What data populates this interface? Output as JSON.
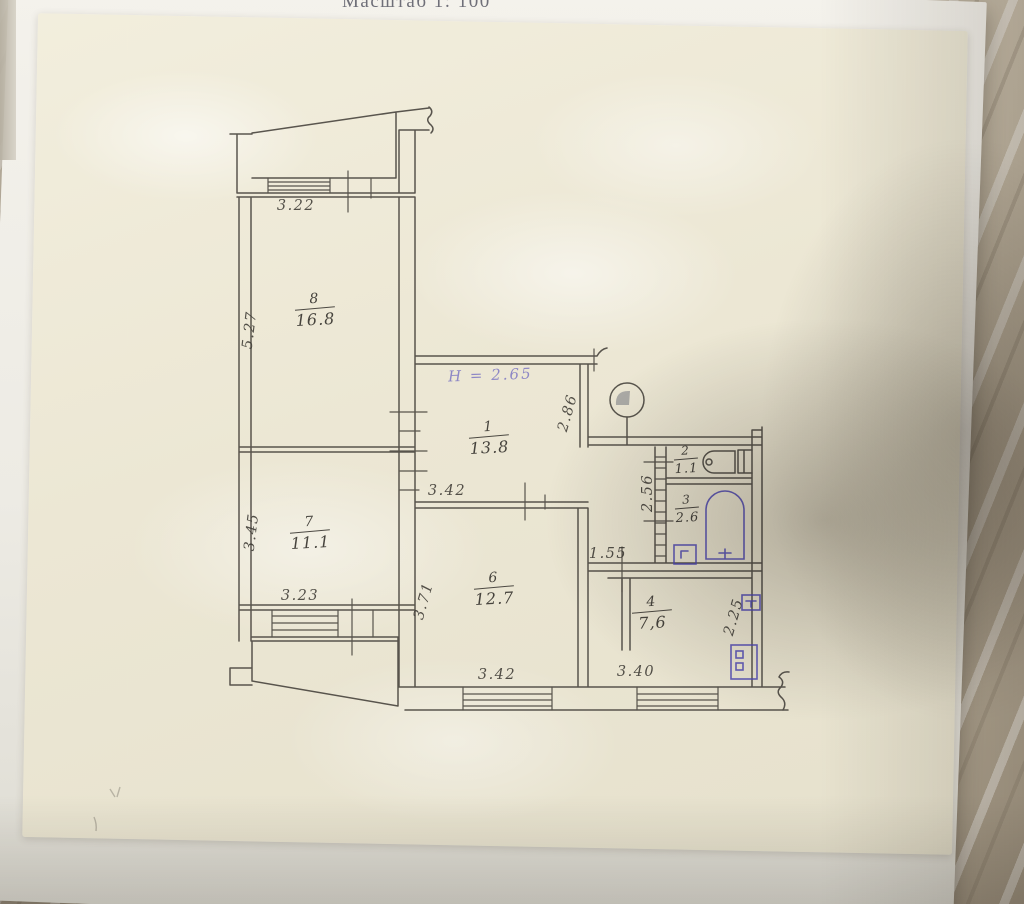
{
  "photo": {
    "caption": "Масштаб 1: 100"
  },
  "plan": {
    "notes": {
      "ceiling_height": "Н = 2.65"
    },
    "rooms": [
      {
        "id": "room-8",
        "number": "8",
        "area": "16.8"
      },
      {
        "id": "room-7",
        "number": "7",
        "area": "11.1"
      },
      {
        "id": "room-1",
        "number": "1",
        "area": "13.8"
      },
      {
        "id": "room-2",
        "number": "2",
        "area": "1.1"
      },
      {
        "id": "room-3",
        "number": "3",
        "area": "2.6"
      },
      {
        "id": "room-6",
        "number": "6",
        "area": "12.7"
      },
      {
        "id": "room-4",
        "number": "4",
        "area": "7,6"
      }
    ],
    "dims": {
      "top_window": "3.22",
      "room8_left": "5.27",
      "room7_left": "3.45",
      "room7_window": "3.23",
      "room6_top": "3.42",
      "room6_left": "3.71",
      "hall_right": "2.86",
      "bath_left": "2.56",
      "corridor": "1.55",
      "kitchen_right": "2.25",
      "bottom_window_left": "3.42",
      "bottom_window_right": "3.40"
    },
    "colors": {
      "ink": "#44403a",
      "purple_ink": "#7d77c3",
      "blue_ink": "#4d47b4"
    }
  }
}
